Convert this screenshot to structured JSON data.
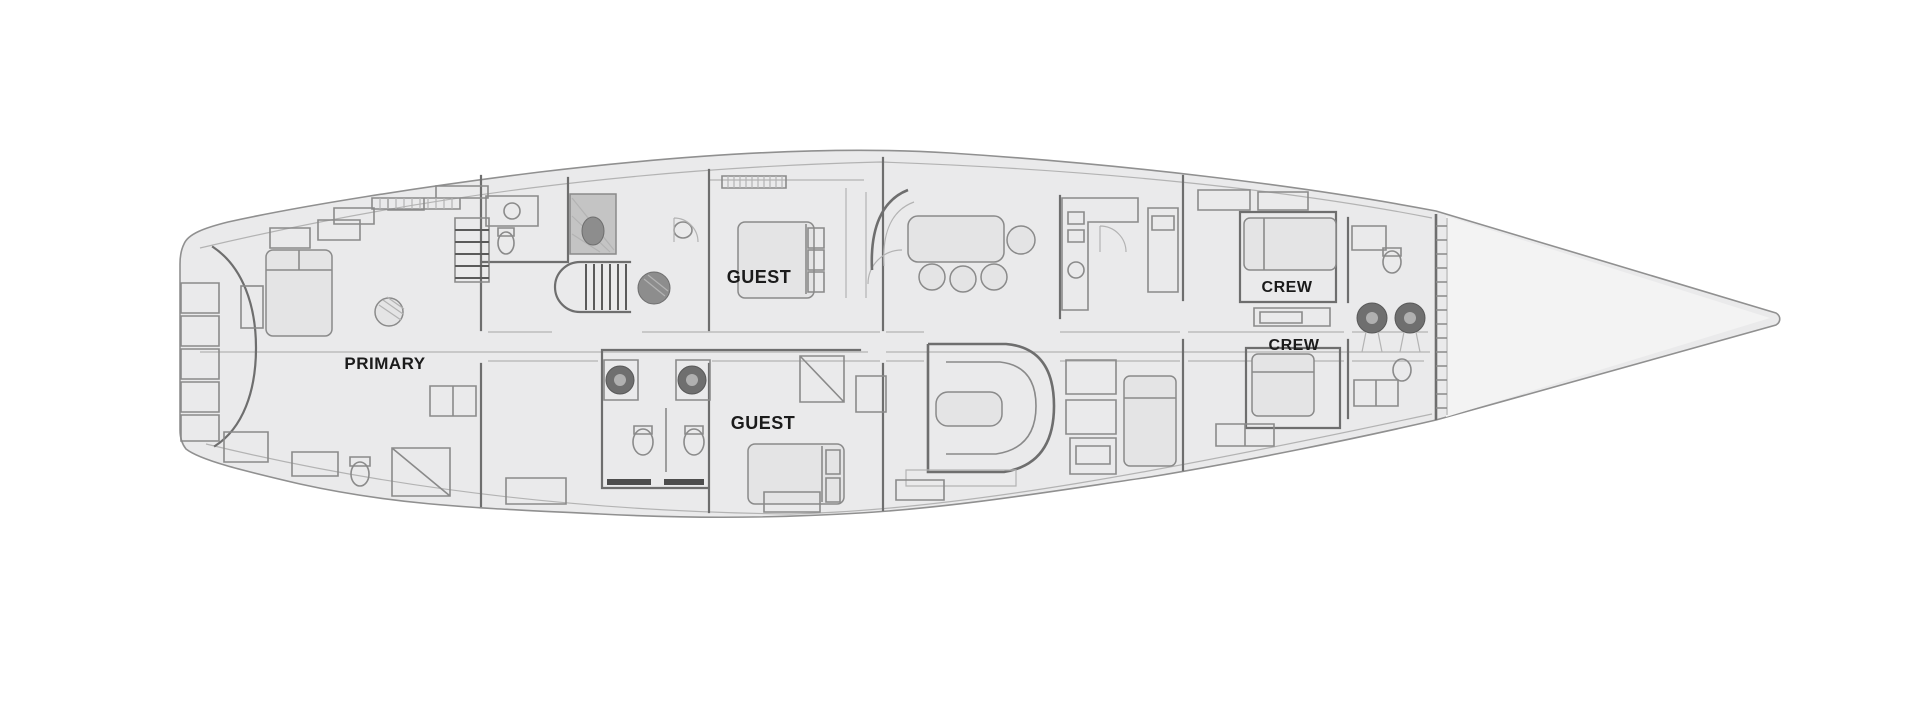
{
  "diagram": {
    "name": "sailing-yacht-interior-deck-plan",
    "type": "floor-plan",
    "orientation": "bow-right",
    "colors": {
      "page_bg": "#ffffff",
      "hull_fill": "#eaeaeb",
      "forepeak_fill": "#f3f3f3",
      "wall_line": "#6e6e6e",
      "furniture_line": "#8a8a8a",
      "fixture_dark": "#6f6f6f",
      "light_line": "#b3b3b3",
      "label_text": "#1b1b1b"
    },
    "labels": [
      {
        "id": "primary-cabin",
        "text": "PRIMARY"
      },
      {
        "id": "guest-cabin-1",
        "text": "GUEST"
      },
      {
        "id": "guest-cabin-2",
        "text": "GUEST"
      },
      {
        "id": "crew-cabin-1",
        "text": "CREW"
      },
      {
        "id": "crew-cabin-2",
        "text": "CREW"
      }
    ]
  }
}
